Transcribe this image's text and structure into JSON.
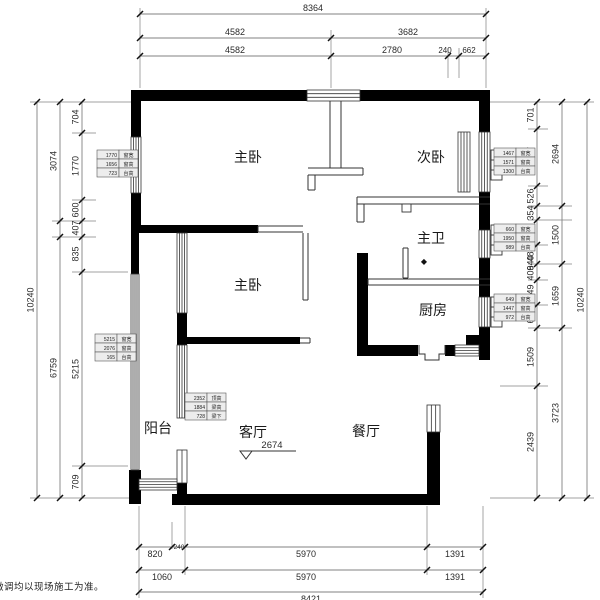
{
  "disclaimer": "微调均以现场施工为准。",
  "colors": {
    "wall": "#000000",
    "thin_line": "#333333",
    "dim_line": "#808080",
    "tick": "#111111",
    "dim_text": "#2b2b2b",
    "room_text": "#1a1a1a",
    "table_fill": "#ededed",
    "table_stroke": "#555555"
  },
  "rooms": [
    {
      "id": "master-bedroom-upper",
      "label": "主卧",
      "x": 248,
      "y": 162
    },
    {
      "id": "second-bedroom",
      "label": "次卧",
      "x": 431,
      "y": 162
    },
    {
      "id": "master-bathroom",
      "label": "主卫",
      "x": 431,
      "y": 243
    },
    {
      "id": "kitchen",
      "label": "厨房",
      "x": 433,
      "y": 315
    },
    {
      "id": "master-bedroom-lower",
      "label": "主卧",
      "x": 248,
      "y": 290
    },
    {
      "id": "balcony",
      "label": "阳台",
      "x": 158,
      "y": 433
    },
    {
      "id": "living-room",
      "label": "客厅",
      "x": 253,
      "y": 437
    },
    {
      "id": "dining-room",
      "label": "餐厅",
      "x": 366,
      "y": 436
    }
  ],
  "bath_symbol": {
    "glyph": "◆",
    "x": 424,
    "y": 264
  },
  "leader": {
    "text": "2674",
    "tx": 272,
    "ty": 448,
    "x1": 252,
    "y1": 451,
    "x2": 296,
    "y2": 451,
    "tri": "240,451 252,451 246,459"
  },
  "dim_rows": [
    {
      "y": 14,
      "from": 140,
      "to": 486,
      "side": "above",
      "ticks": [
        140,
        486
      ],
      "labels": [
        {
          "t": "8364",
          "x": 313
        }
      ]
    },
    {
      "y": 38,
      "from": 140,
      "to": 486,
      "side": "above",
      "ticks": [
        140,
        331,
        486
      ],
      "labels": [
        {
          "t": "4582",
          "x": 235
        },
        {
          "t": "3682",
          "x": 408
        }
      ]
    },
    {
      "y": 56,
      "from": 140,
      "to": 486,
      "side": "above",
      "ticks": [
        140,
        331,
        448,
        459,
        486
      ],
      "labels": [
        {
          "t": "4582",
          "x": 235
        },
        {
          "t": "2780",
          "x": 392
        },
        {
          "t": "240",
          "x": 445,
          "fs": 8
        },
        {
          "t": "662",
          "x": 469,
          "fs": 8
        }
      ]
    },
    {
      "y": 547,
      "from": 139,
      "to": 483,
      "side": "below",
      "ticks": [
        139,
        172,
        185,
        427,
        483
      ],
      "labels": [
        {
          "t": "820",
          "x": 155
        },
        {
          "t": "240",
          "x": 179,
          "fs": 6.5,
          "dy": -8
        },
        {
          "t": "5970",
          "x": 306
        },
        {
          "t": "1391",
          "x": 455
        }
      ]
    },
    {
      "y": 570,
      "from": 139,
      "to": 483,
      "side": "below",
      "ticks": [
        139,
        185,
        427,
        483
      ],
      "labels": [
        {
          "t": "1060",
          "x": 162
        },
        {
          "t": "5970",
          "x": 306
        },
        {
          "t": "1391",
          "x": 455
        }
      ]
    },
    {
      "y": 592,
      "from": 139,
      "to": 483,
      "side": "below",
      "ticks": [
        139,
        483
      ],
      "labels": [
        {
          "t": "8421",
          "x": 311
        }
      ]
    }
  ],
  "dim_cols": [
    {
      "x": 37,
      "from": 102,
      "to": 498,
      "ticks": [
        102,
        498
      ],
      "labels": [
        {
          "t": "10240",
          "y": 300
        }
      ]
    },
    {
      "x": 60,
      "from": 102,
      "to": 498,
      "ticks": [
        102,
        221,
        237,
        498
      ],
      "labels": [
        {
          "t": "3074",
          "y": 161
        },
        {
          "t": "6759",
          "y": 368
        }
      ]
    },
    {
      "x": 82,
      "from": 102,
      "to": 498,
      "ticks": [
        102,
        133,
        200,
        221,
        237,
        272,
        466,
        498
      ],
      "labels": [
        {
          "t": "704",
          "y": 117
        },
        {
          "t": "1770",
          "y": 166
        },
        {
          "t": "600",
          "y": 210
        },
        {
          "t": "407",
          "y": 228
        },
        {
          "t": "835",
          "y": 254
        },
        {
          "t": "5215",
          "y": 369
        },
        {
          "t": "709",
          "y": 482
        }
      ]
    },
    {
      "x": 537,
      "from": 102,
      "to": 498,
      "ticks": [
        102,
        129,
        186,
        206,
        220,
        245,
        264,
        280,
        305,
        328,
        386,
        498
      ],
      "labels": [
        {
          "t": "701",
          "y": 115
        },
        {
          "t": "1467",
          "y": 157
        },
        {
          "t": "526",
          "y": 196
        },
        {
          "t": "354",
          "y": 213
        },
        {
          "t": "660",
          "y": 232
        },
        {
          "t": "486",
          "y": 254
        },
        {
          "t": "940",
          "y": 263
        },
        {
          "t": "406",
          "y": 273
        },
        {
          "t": "649",
          "y": 292
        },
        {
          "t": "604",
          "y": 316
        },
        {
          "t": "1509",
          "y": 357
        },
        {
          "t": "2439",
          "y": 442
        }
      ]
    },
    {
      "x": 562,
      "from": 102,
      "to": 498,
      "ticks": [
        102,
        206,
        264,
        328,
        498
      ],
      "labels": [
        {
          "t": "2694",
          "y": 154
        },
        {
          "t": "1500",
          "y": 235
        },
        {
          "t": "1659",
          "y": 296
        },
        {
          "t": "3723",
          "y": 413
        }
      ]
    },
    {
      "x": 587,
      "from": 102,
      "to": 498,
      "ticks": [
        102,
        498
      ],
      "labels": [
        {
          "t": "10240",
          "y": 300
        }
      ]
    }
  ],
  "tag_tables": [
    {
      "x": 97,
      "y": 150,
      "rows": [
        [
          "1770",
          "窗宽"
        ],
        [
          "1656",
          "窗高"
        ],
        [
          "723",
          "台高"
        ]
      ]
    },
    {
      "x": 95,
      "y": 334,
      "rows": [
        [
          "5215",
          "窗宽"
        ],
        [
          "2076",
          "窗高"
        ],
        [
          "165",
          "台高"
        ]
      ]
    },
    {
      "x": 494,
      "y": 148,
      "rows": [
        [
          "1467",
          "窗宽"
        ],
        [
          "1571",
          "窗高"
        ],
        [
          "1300",
          "台高"
        ]
      ]
    },
    {
      "x": 494,
      "y": 224,
      "rows": [
        [
          "660",
          "窗宽"
        ],
        [
          "1950",
          "窗高"
        ],
        [
          "989",
          "台高"
        ]
      ]
    },
    {
      "x": 494,
      "y": 294,
      "rows": [
        [
          "649",
          "窗宽"
        ],
        [
          "1447",
          "窗高"
        ],
        [
          "972",
          "台高"
        ]
      ]
    },
    {
      "x": 185,
      "y": 393,
      "rows": [
        [
          "2352",
          "顶高"
        ],
        [
          "1884",
          "梁高"
        ],
        [
          "728",
          "梁下"
        ]
      ]
    }
  ]
}
